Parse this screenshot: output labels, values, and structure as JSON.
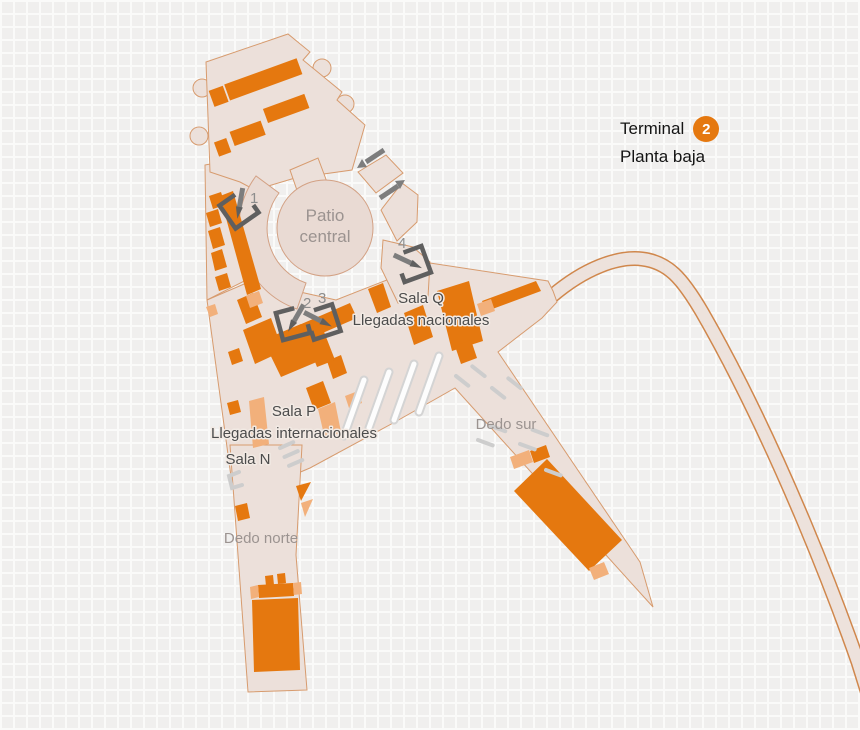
{
  "title": {
    "terminal_label": "Terminal",
    "terminal_number": "2",
    "floor_label": "Planta baja"
  },
  "map": {
    "areas": {
      "patio_central": {
        "line1": "Patio",
        "line2": "central"
      },
      "sala_q": {
        "name": "Sala Q",
        "sub": "Llegadas nacionales"
      },
      "sala_p": {
        "name": "Sala P",
        "sub": "Llegadas internacionales"
      },
      "sala_n": {
        "name": "Sala N"
      },
      "dedo_norte": {
        "name": "Dedo norte"
      },
      "dedo_sur": {
        "name": "Dedo sur"
      }
    },
    "markers": [
      {
        "number": "1"
      },
      {
        "number": "2"
      },
      {
        "number": "3"
      },
      {
        "number": "4"
      }
    ],
    "icons": {
      "entry_marker": "entry-arrow-icon",
      "flow_up": "flow-arrow-upright-icon",
      "flow_down": "flow-arrow-downleft-icon"
    },
    "colors": {
      "accent_orange": "#e5780f",
      "salmon": "#f2b07b",
      "building_fill": "#ece0da",
      "building_stroke": "#d79b6e",
      "marker_gray": "#5f5f5f",
      "label_gray": "#9b9390",
      "label_dark": "#4c4c4c"
    }
  }
}
